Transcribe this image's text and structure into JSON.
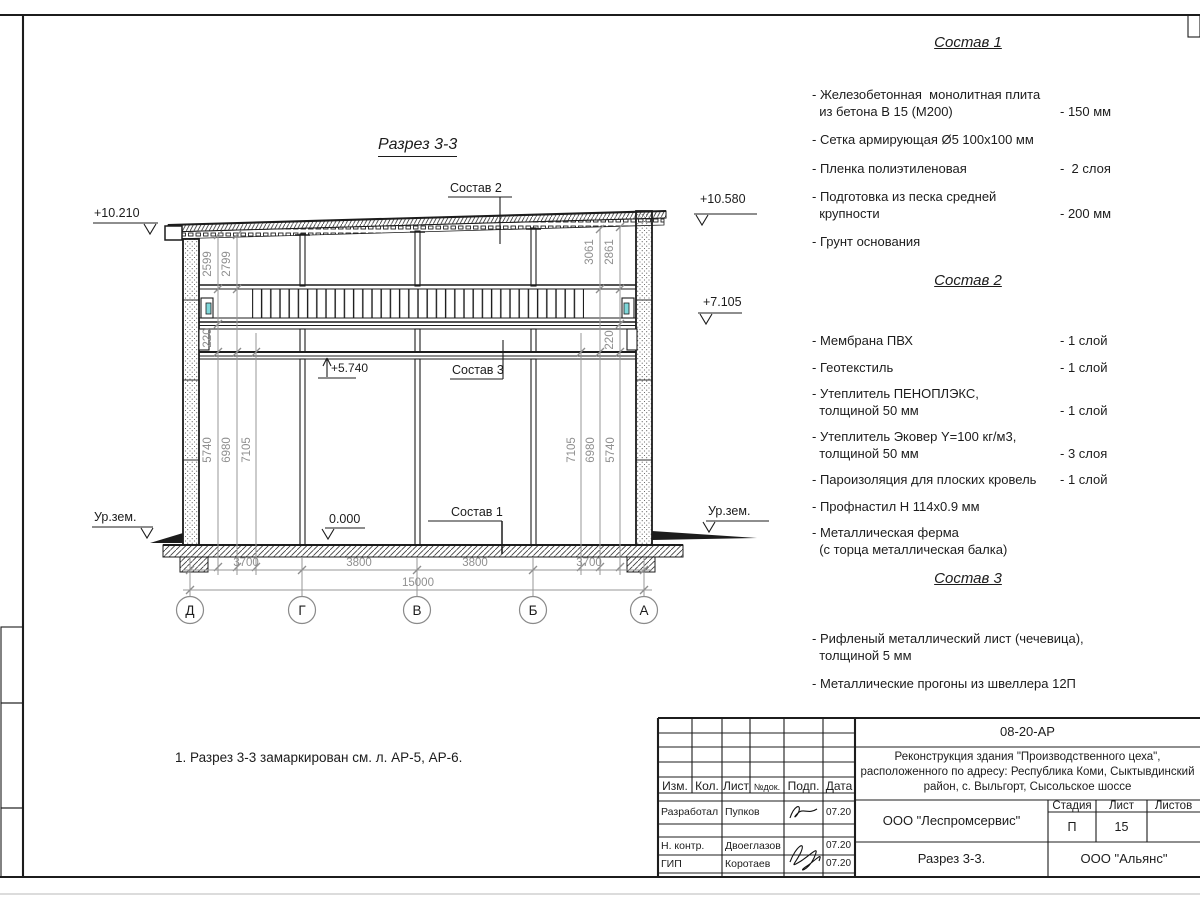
{
  "colors": {
    "line": "#1c1c1c",
    "dim": "#8f8f8f",
    "accent_cyan": "#7fd8da"
  },
  "drawing": {
    "title": "Разрез 3-3",
    "note": "1. Разрез 3-3 замаркирован см. л. АР-5, АР-6.",
    "elevations": {
      "top_left": "+10.210",
      "top_right": "+10.580",
      "mid_right": "+7.105",
      "mezzanine": "+5.740",
      "floor": "0.000",
      "ground_left": "Ур.зем.",
      "ground_right": "Ур.зем."
    },
    "leader_labels": {
      "sostav1": "Состав 1",
      "sostav2": "Состав 2",
      "sostav3": "Состав 3"
    },
    "axes": [
      "Д",
      "Г",
      "В",
      "Б",
      "А"
    ],
    "dims_bottom": [
      "3700",
      "3800",
      "3800",
      "3700"
    ],
    "dim_total": "15000",
    "dims_left_top": [
      "2599",
      "2799"
    ],
    "dims_right_top": [
      "3061",
      "2861"
    ],
    "dims_left": [
      "5740",
      "6980",
      "7105"
    ],
    "dims_right": [
      "7105",
      "6980",
      "5740"
    ],
    "dim_220": "220"
  },
  "lists": [
    {
      "title": "Состав 1",
      "items": [
        {
          "name": "- Железобетонная  монолитная плита\n  из бетона В 15 (М200)",
          "value": "- 150 мм"
        },
        {
          "name": "- Сетка армирующая Ø5 100х100 мм",
          "value": ""
        },
        {
          "name": "- Пленка полиэтиленовая",
          "value": "-  2 слоя"
        },
        {
          "name": "- Подготовка из песка средней\n  крупности",
          "value": "- 200 мм"
        },
        {
          "name": "- Грунт основания",
          "value": ""
        }
      ]
    },
    {
      "title": "Состав 2",
      "items": [
        {
          "name": "- Мембрана ПВХ",
          "value": "- 1 слой"
        },
        {
          "name": "- Геотекстиль",
          "value": "- 1 слой"
        },
        {
          "name": "- Утеплитель ПЕНОПЛЭКС,\n  толщиной 50 мм",
          "value": "- 1 слой"
        },
        {
          "name": "- Утеплитель Эковер Y=100 кг/м3,\n  толщиной 50 мм",
          "value": "- 3 слоя"
        },
        {
          "name": "- Пароизоляция для плоских кровель",
          "value": "- 1 слой"
        },
        {
          "name": "- Профнастил Н 114х0.9 мм",
          "value": ""
        },
        {
          "name": "- Металлическая ферма\n  (с торца металлическая балка)",
          "value": ""
        }
      ]
    },
    {
      "title": "Состав 3",
      "items": [
        {
          "name": "- Рифленый металлический лист (чечевица),\n  толщиной 5 мм",
          "value": ""
        },
        {
          "name": "- Металлические прогоны из швеллера 12П",
          "value": ""
        }
      ]
    }
  ],
  "titleblock": {
    "code": "08-20-АР",
    "project": "Реконструкция здания \"Производственного цеха\",\nрасположенного по адресу: Республика Коми, Сыктывдинский\nрайон, с. Выльгорт, Сысольское шоссе",
    "org": "ООО \"Леспромсервис\"",
    "dwg_name": "Разрез 3-3.",
    "contractor": "ООО \"Альянс\"",
    "stage_label": "Стадия",
    "sheet_label": "Лист",
    "sheets_label": "Листов",
    "stage": "П",
    "sheet": "15",
    "sheets": "",
    "cols": [
      "Изм.",
      "Кол.",
      "Лист",
      "№док.",
      "Подп.",
      "Дата"
    ],
    "rows": [
      {
        "role": "Разработал",
        "name": "Пупков",
        "date": "07.20"
      },
      {
        "role": "Н. контр.",
        "name": "Двоеглазов",
        "date": "07.20"
      },
      {
        "role": "ГИП",
        "name": "Коротаев",
        "date": "07.20"
      }
    ]
  }
}
